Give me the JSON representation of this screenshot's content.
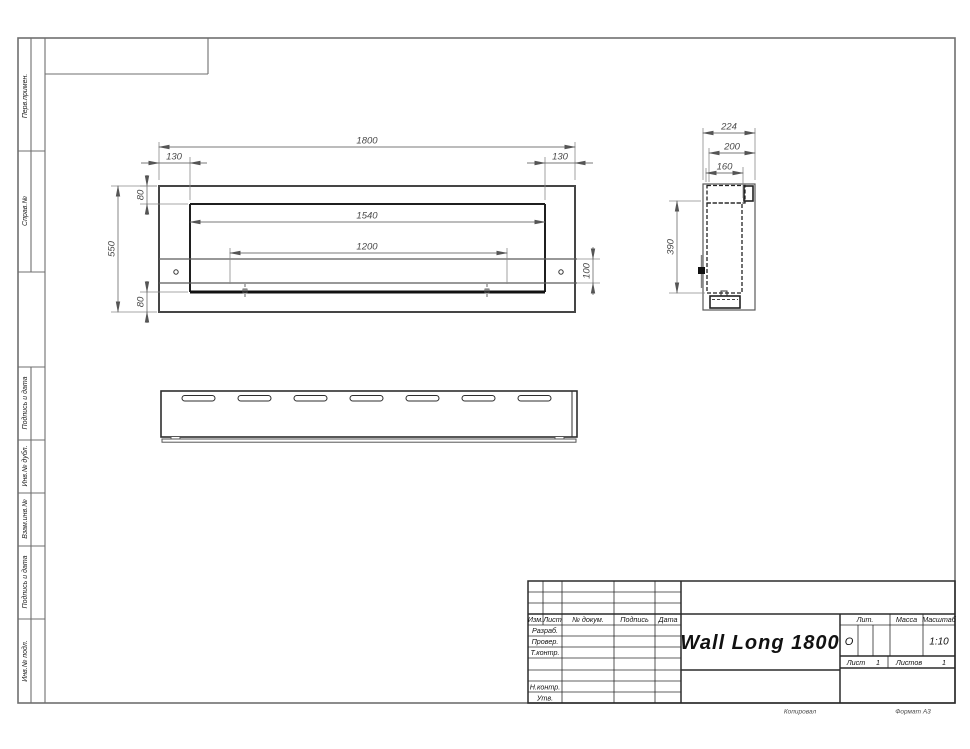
{
  "frame_labels": {
    "perv_primen": "Перв.примен.",
    "sprav_no": "Справ.№",
    "podpis_data_1": "Подпись и дата",
    "inv_dubl": "Инв.№ дубл.",
    "vzam_inv": "Взам.инв.№",
    "podpis_data_2": "Подпись и дата",
    "inv_podl": "Инв.№ подл."
  },
  "dims": {
    "front": {
      "overall_width": "1800",
      "offset_left": "130",
      "offset_right": "130",
      "inset_top": "80",
      "opening_width": "1540",
      "bracket_span": "1200",
      "overall_height": "550",
      "bracket_height": "100",
      "inset_bottom": "80"
    },
    "side": {
      "overall_depth": "224",
      "body_depth": "200",
      "opening_depth": "160",
      "inner_height": "390"
    }
  },
  "title_block": {
    "title": "Wall Long 1800",
    "cols": {
      "izm": "Изм.",
      "list": "Лист",
      "doc": "№ докум.",
      "podpis": "Подпись",
      "data": "Дата"
    },
    "rows": {
      "razrab": "Разраб.",
      "prover": "Провер.",
      "tkontr": "Т.контр.",
      "nkontr": "Н.контр.",
      "utv": "Утв."
    },
    "lit": {
      "label": "Лит.",
      "value": "О"
    },
    "massa": {
      "label": "Масса"
    },
    "scale": {
      "label": "Масштаб",
      "value": "1:10"
    },
    "sheet": {
      "label": "Лист",
      "value": "1"
    },
    "sheets": {
      "label": "Листов",
      "value": "1"
    }
  },
  "footer": {
    "copy": "Копировал",
    "format": "Формат А3"
  },
  "colors": {
    "line_main": "#2a2a2a",
    "line_thin": "#6f6f6f",
    "dim_text": "#4a4a4a"
  }
}
